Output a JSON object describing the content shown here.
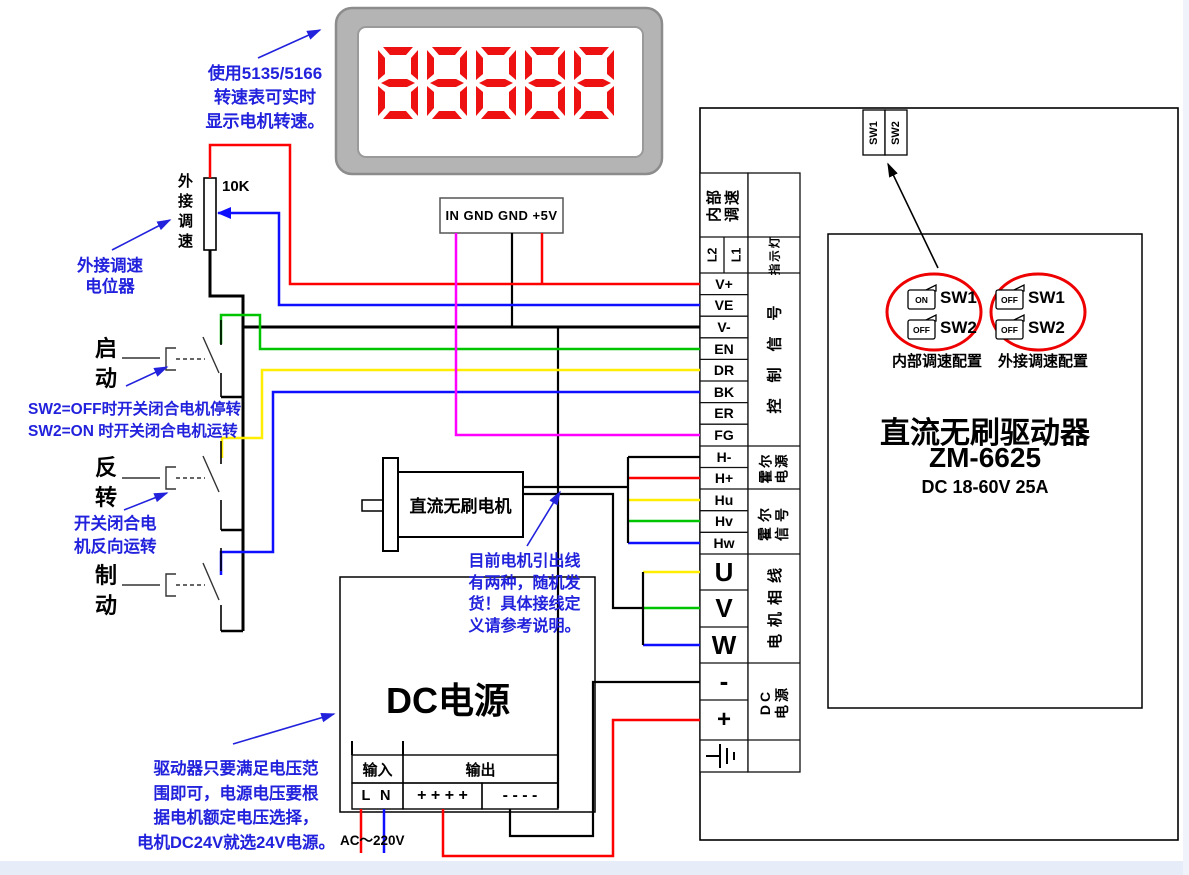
{
  "tachometer": {
    "display_value": "88888",
    "connector_label": "IN GND GND +5V",
    "note": [
      "使用5135/5166",
      "转速表可实时",
      "显示电机转速。"
    ]
  },
  "potentiometer": {
    "vertical_label": "外接调速",
    "value": "10K",
    "note": [
      "外接调速",
      "电位器"
    ]
  },
  "switches": {
    "start_label": "启动",
    "reverse_label": "反转",
    "brake_label": "制动",
    "sw2_note": [
      "SW2=OFF时开关闭合电机停转",
      "SW2=ON 时开关闭合电机运转"
    ],
    "reverse_note": [
      "开关闭合电",
      "机反向运转"
    ]
  },
  "motor": {
    "label": "直流无刷电机",
    "note": [
      "目前电机引出线",
      "有两种，随机发",
      "货！具体接线定",
      "义请参考说明。"
    ]
  },
  "power_supply": {
    "title": "DC电源",
    "input_header": "输入",
    "input_terminals": "L N",
    "output_header": "输出",
    "output_plus": "+ + + +",
    "output_minus": "- - - -",
    "ac_label": "AC～220V",
    "note": [
      "驱动器只要满足电压范",
      "围即可，电源电压要根",
      "据电机额定电压选择，",
      "电机DC24V就选24V电源。"
    ]
  },
  "driver": {
    "title": "直流无刷驱动器",
    "model": "ZM-6625",
    "spec": "DC 18-60V 25A",
    "top_tabs": [
      "SW1",
      "SW2"
    ],
    "dip_configs": [
      {
        "caption": "内部调速配置",
        "rows": [
          {
            "state": "ON",
            "label": "SW1"
          },
          {
            "state": "OFF",
            "label": "SW2"
          }
        ]
      },
      {
        "caption": "外接调速配置",
        "rows": [
          {
            "state": "OFF",
            "label": "SW1"
          },
          {
            "state": "OFF",
            "label": "SW2"
          }
        ]
      }
    ]
  },
  "terminal_strip": {
    "speed_cell": [
      "内部",
      "调速"
    ],
    "indicator_t1": "L2",
    "indicator_t2": "L1",
    "indicator_label": "指示灯",
    "control_terminals": [
      "V+",
      "VE",
      "V-",
      "EN",
      "DR",
      "BK",
      "ER",
      "FG"
    ],
    "control_label": "控制信号",
    "hall_power_terminals": [
      "H-",
      "H+"
    ],
    "hall_power_label": [
      "霍尔",
      "电源"
    ],
    "hall_signal_terminals": [
      "Hu",
      "Hv",
      "Hw"
    ],
    "hall_signal_label": [
      "霍尔",
      "信号"
    ],
    "phase_terminals": [
      "U",
      "V",
      "W"
    ],
    "phase_label": "电机相线",
    "dc_terminals": [
      "-",
      "+"
    ],
    "dc_label": [
      "DC",
      "电源"
    ]
  },
  "colors": {
    "wire_red": "#ff0000",
    "wire_blue": "#0f0fff",
    "wire_green": "#00c400",
    "wire_yellow": "#ffee00",
    "wire_magenta": "#ff00ff",
    "annotation_blue": "#2222dd",
    "highlight_red": "#ee0000",
    "display_digit_red": "#ee1111"
  }
}
